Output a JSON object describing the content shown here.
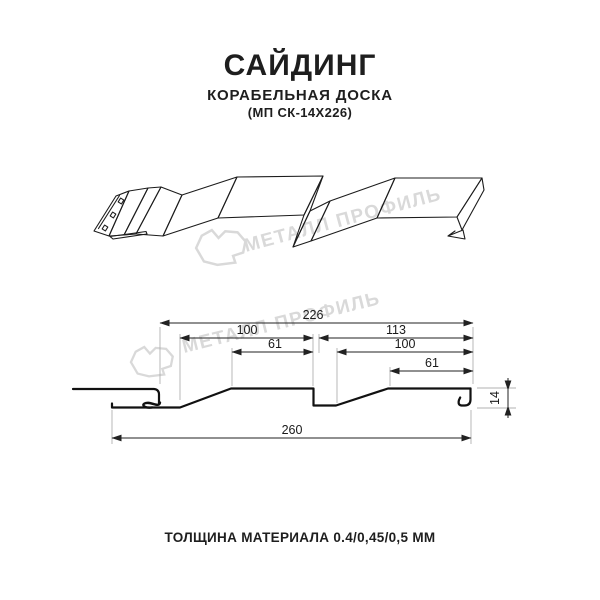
{
  "header": {
    "title": "САЙДИНГ",
    "subtitle": "КОРАБЕЛЬНАЯ ДОСКА",
    "model": "(МП СК-14Х226)"
  },
  "watermark": {
    "text": "МЕТАЛЛ ПРОФИЛЬ",
    "color": "#d9d9d9"
  },
  "drawing": {
    "kind": "siding profile, 3d view above dimensioned cross-section",
    "line_color": "#1a1a1a"
  },
  "dimensions": {
    "top_total": "226",
    "left_module": "100",
    "right_module": "113",
    "left_crest": "61",
    "right_inner": "100",
    "right_crest": "61",
    "bottom_total": "260",
    "profile_height": "14"
  },
  "footer": {
    "text": "ТОЛЩИНА МАТЕРИАЛА 0.4/0,45/0,5 ММ"
  }
}
